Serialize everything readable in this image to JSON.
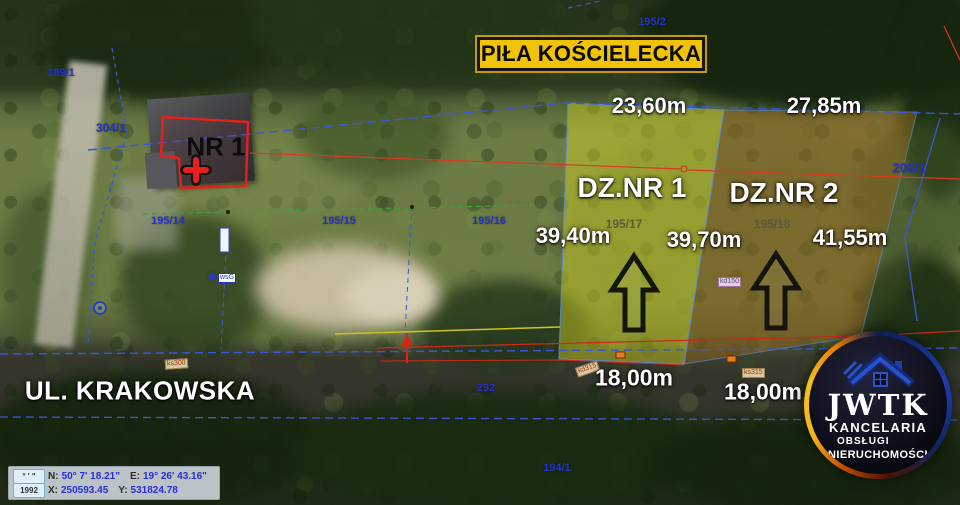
{
  "banner": {
    "title": "PIŁA KOŚCIELECKA"
  },
  "map": {
    "street_label": "UL. KRAKOWSKA",
    "building_label": "NR 1",
    "parcels": [
      {
        "name": "DZ.NR 1",
        "number": "195/17",
        "width_top": "23,60m",
        "length_left": "39,40m",
        "length_right": "39,70m",
        "width_bottom": "18,00m"
      },
      {
        "name": "DZ.NR 2",
        "number": "195/18",
        "width_top": "27,85m",
        "length_right": "41,55m",
        "width_bottom": "18,00m"
      }
    ],
    "cadastral_numbers": [
      {
        "text": "195/2"
      },
      {
        "text": "189/1"
      },
      {
        "text": "304/1"
      },
      {
        "text": "195/14"
      },
      {
        "text": "195/15"
      },
      {
        "text": "195/16"
      },
      {
        "text": "206/1"
      },
      {
        "text": "292"
      },
      {
        "text": "194/1"
      }
    ],
    "utility_labels": [
      {
        "text": "ks300"
      },
      {
        "text": "kd315"
      },
      {
        "text": "kd150"
      },
      {
        "text": "ks315"
      },
      {
        "text": "wsG"
      }
    ]
  },
  "logo": {
    "brand": "JWTK",
    "line1": "KANCELARIA",
    "line2": "OBSŁUGI",
    "line3": "NIERUCHOMOŚCI"
  },
  "statusbar": {
    "angle_button": "° ' \"",
    "crs_button": "1992",
    "n_label": "N:",
    "n_value": "50° 7' 18.21\"",
    "e_label": "E:",
    "e_value": "19° 26' 43.16\"",
    "x_label": "X:",
    "x_value": "250593.45",
    "y_label": "Y:",
    "y_value": "531824.78"
  },
  "colors": {
    "banner_bg": "#F2C304",
    "parcel1_tint": "rgba(222,222,30,0.42)",
    "parcel2_tint": "rgba(150,100,30,0.48)",
    "cadastral_blue": "#2531C9",
    "accent_red": "#E2201C"
  }
}
